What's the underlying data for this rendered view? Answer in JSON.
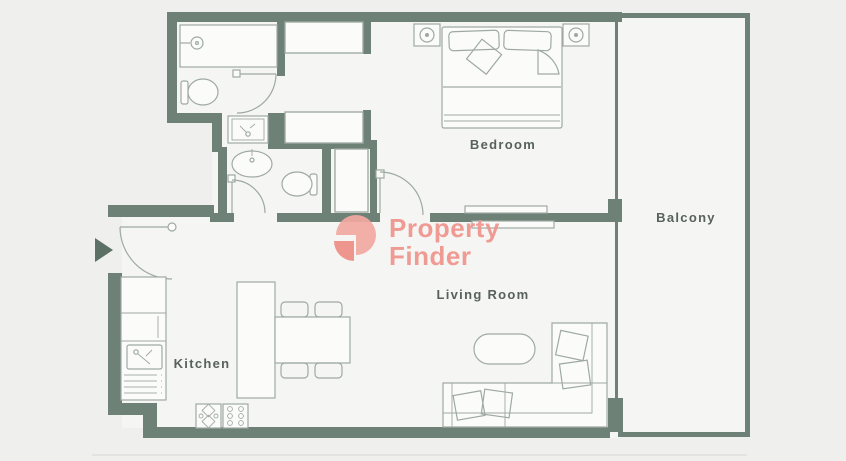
{
  "floorplan": {
    "type": "apartment-floor-plan",
    "rooms": [
      {
        "id": "bedroom",
        "label": "Bedroom"
      },
      {
        "id": "balcony",
        "label": "Balcony"
      },
      {
        "id": "living_room",
        "label": "Living Room"
      },
      {
        "id": "kitchen",
        "label": "Kitchen"
      }
    ],
    "watermark": {
      "line1": "Property",
      "line2": "Finder"
    },
    "fixtures": [
      "bathtub",
      "shower-head-icon",
      "toilet",
      "vanity-sink",
      "wash-basin",
      "wardrobe",
      "linen-shelves",
      "bed",
      "pillow",
      "nightstand-lamp",
      "sliding-door",
      "hinged-door",
      "entry-arrow-icon",
      "kitchen-counter",
      "fridge",
      "kitchen-sink",
      "drawer-unit",
      "kitchen-island",
      "stove",
      "dining-table",
      "dining-chair",
      "sofa",
      "sofa-cushion",
      "coffee-table"
    ],
    "colors": {
      "wall": "#6e8177",
      "background": "#eff0ee",
      "floor": "#f5f6f3",
      "fixture": "#fbfcfa",
      "line": "#9fa9a3",
      "label": "#57615d",
      "logo_primary": "#f0938d",
      "logo_light": "#f2a9a2",
      "logo_dark": "#ee8e86",
      "edge": "#e2e4e1"
    }
  }
}
